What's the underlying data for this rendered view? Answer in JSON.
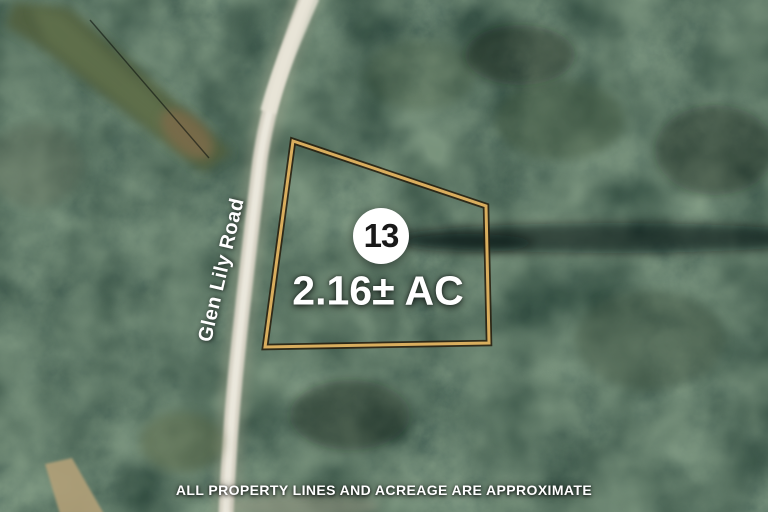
{
  "map": {
    "road_label": "Glen Lily Road",
    "lot": {
      "number": "13",
      "acreage": "2.16± AC"
    },
    "disclaimer": "ALL PROPERTY LINES AND ACREAGE ARE APPROXIMATE",
    "boundary": {
      "points": "293,141 486,206 489,343 265,347",
      "stroke_color": "#d9ae5e",
      "outline_color": "#261c0c"
    },
    "colors": {
      "forest_dark": "#121c15",
      "forest_mid": "#2c3b2e",
      "forest_light": "#4f6a4a",
      "road": "#d8d4c6",
      "clearing": "#51603f",
      "dirt": "#7b6a4a",
      "trail_tan": "#b2a078",
      "badge_bg": "#ffffff",
      "badge_text": "#191919",
      "label_text": "#ffffff"
    }
  }
}
